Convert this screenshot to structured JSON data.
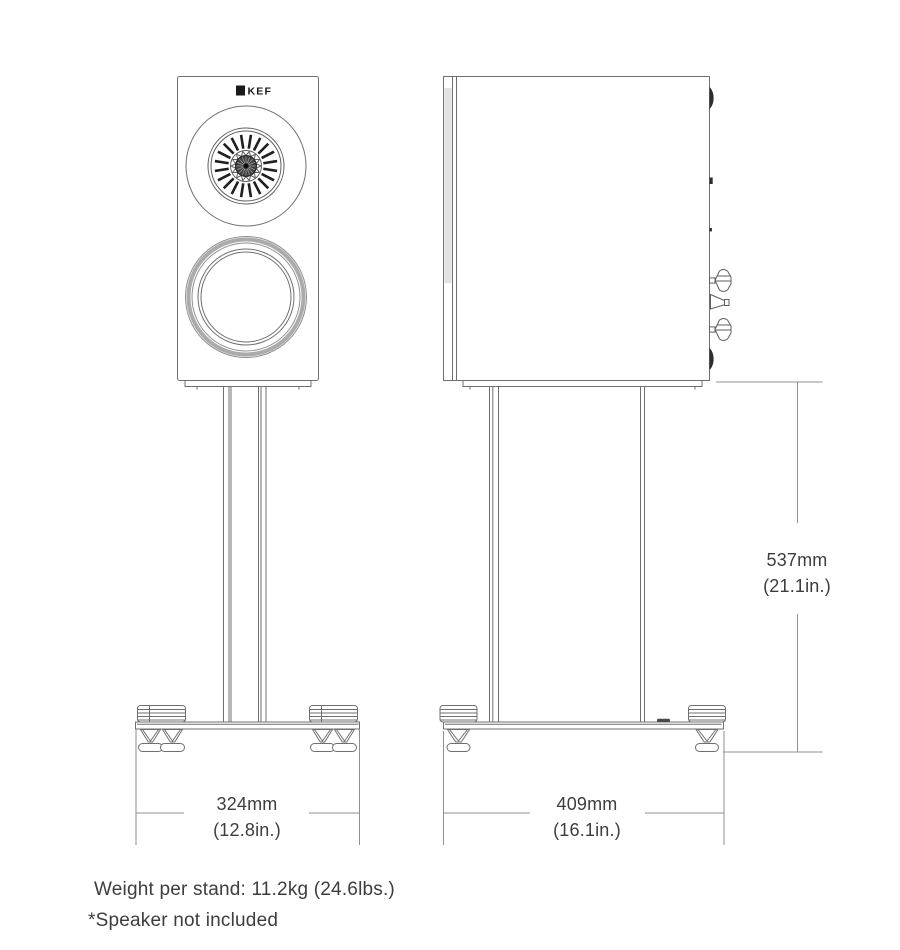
{
  "brand": {
    "logo": "KEF"
  },
  "dimensions": {
    "stand_width": {
      "metric": "324mm",
      "imperial": "(12.8in.)"
    },
    "stand_depth": {
      "metric": "409mm",
      "imperial": "(16.1in.)"
    },
    "stand_height": {
      "metric": "537mm",
      "imperial": "(21.1in.)"
    }
  },
  "notes": {
    "weight": "Weight per stand: 11.2kg (24.6lbs.)",
    "disclaimer": "*Speaker not included"
  },
  "colors": {
    "line": "#6f6f6f",
    "line2": "#5f5f5f",
    "dim_line": "#8f8f8f",
    "text": "#3d3d3d",
    "dark": "#2e2e2e",
    "band": "#ababab"
  }
}
